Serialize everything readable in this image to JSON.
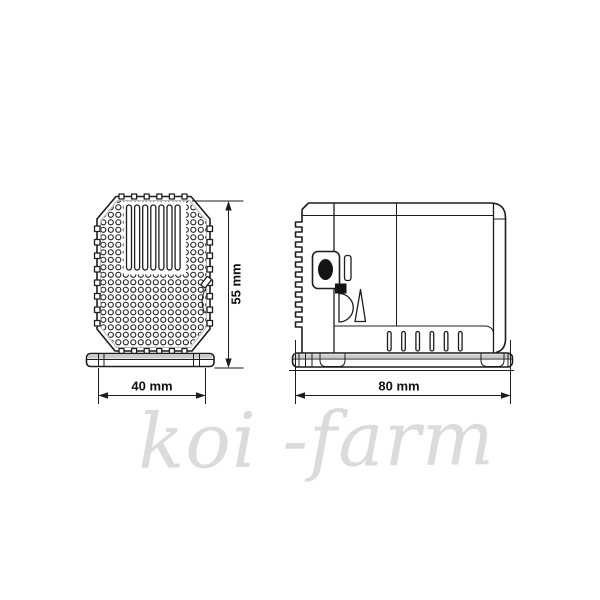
{
  "watermark": {
    "text": "koi -farm",
    "color": "#dbdbdb"
  },
  "views": {
    "front": {
      "height_dim": "55 mm",
      "width_dim": "40 mm"
    },
    "side": {
      "width_dim": "80 mm"
    }
  },
  "colors": {
    "background": "#ffffff",
    "line": "#1d1d1d",
    "knob_fill": "#141414",
    "base_shading": "#cbcbcb",
    "watermark_gray": "#dbdbdb"
  }
}
